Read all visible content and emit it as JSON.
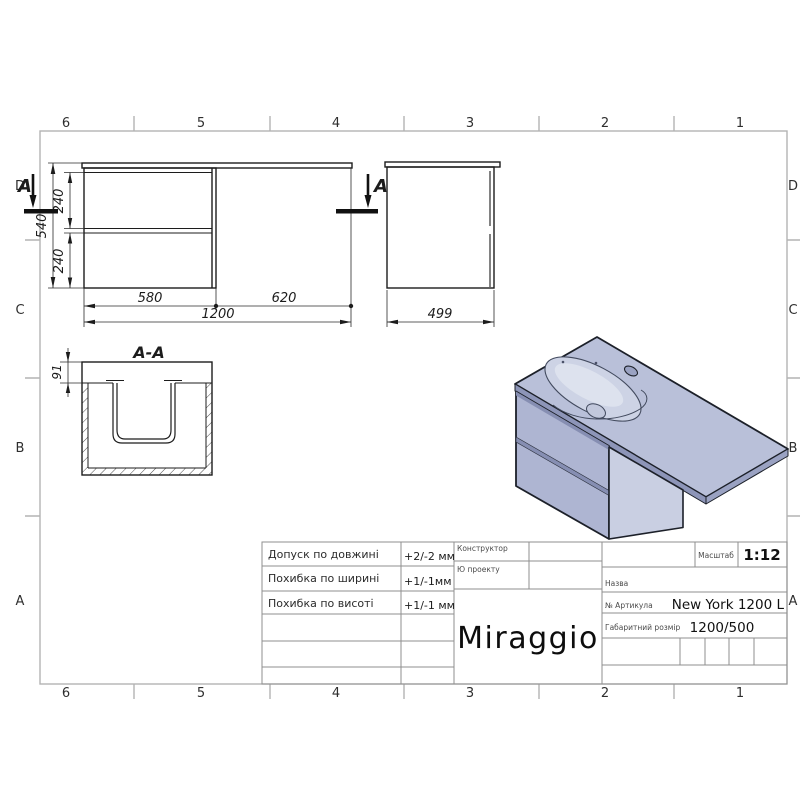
{
  "frame": {
    "cols": [
      "6",
      "5",
      "4",
      "3",
      "2",
      "1"
    ],
    "rows": [
      "D",
      "C",
      "B",
      "A"
    ]
  },
  "views": {
    "front": {
      "dim_height_total": "540",
      "dim_drawer_top": "240",
      "dim_drawer_bottom": "240",
      "dim_width_left": "580",
      "dim_width_right": "620",
      "dim_width_total": "1200",
      "section_mark_left": "A",
      "section_mark_right": "A"
    },
    "side": {
      "dim_depth": "499"
    },
    "section": {
      "title": "A-A",
      "dim_top_thickness": "91"
    }
  },
  "title_block": {
    "tolerances": [
      {
        "label": "Допуск по довжині",
        "value": "+2/-2 мм"
      },
      {
        "label": "Похибка по ширині",
        "value": "+1/-1мм"
      },
      {
        "label": "Похибка по висоті",
        "value": "+1/-1 мм"
      }
    ],
    "designer_label": "Конструктор",
    "project_id_label": "Ю проекту",
    "logo": "Miraggio",
    "scale_label": "Масштаб",
    "scale_value": "1:12",
    "name_label": "Назва",
    "article_label": "№  Артикула",
    "article_value": "New York 1200 L",
    "size_label": "Габаритний розмір",
    "size_value": "1200/500"
  },
  "colors": {
    "product_top": "#b9c0d9",
    "product_front": "#aeb5d2",
    "product_side": "#c9cfe2",
    "line": "#1c2029",
    "frame_line": "#b3b3b3",
    "table_line": "#8f8f8f"
  }
}
